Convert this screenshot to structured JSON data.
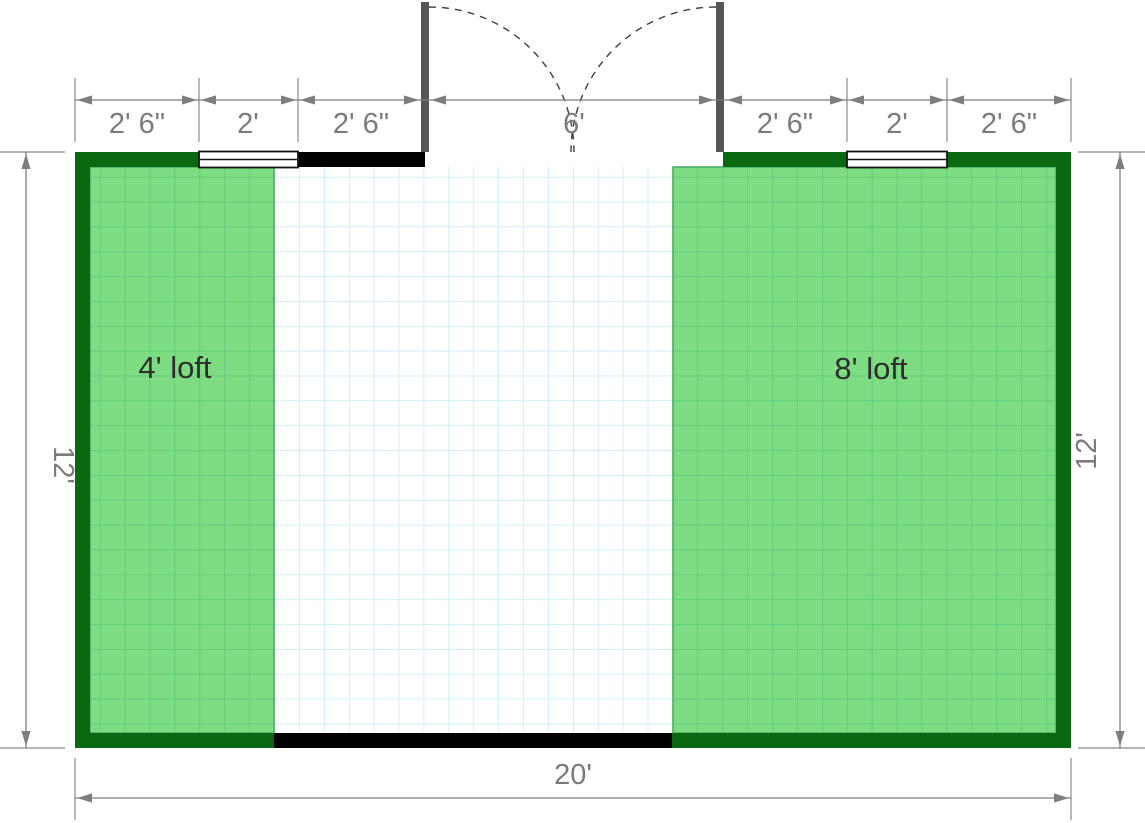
{
  "floor_plan": {
    "lofts": [
      {
        "label": "4'  loft"
      },
      {
        "label": "8'  loft"
      }
    ],
    "dimensions": {
      "top": [
        {
          "label": "2' 6\""
        },
        {
          "label": "2'"
        },
        {
          "label": "2' 6\""
        },
        {
          "label": "6'"
        },
        {
          "label": "2' 6\""
        },
        {
          "label": "2'"
        },
        {
          "label": "2' 6\""
        }
      ],
      "left": {
        "label": "12'"
      },
      "right": {
        "label": "12'"
      },
      "bottom": {
        "label": "20'"
      }
    },
    "colors": {
      "loft_wall_green": "#096810",
      "wall_black": "#000000",
      "loft_fill": "#7edc83",
      "loft_grid_line": "#53c478",
      "floor_grid_line": "#b5e7f7",
      "dimension_gray": "#7b7b7b",
      "door_frame_gray": "#555555",
      "window_white": "#ffffff"
    }
  }
}
